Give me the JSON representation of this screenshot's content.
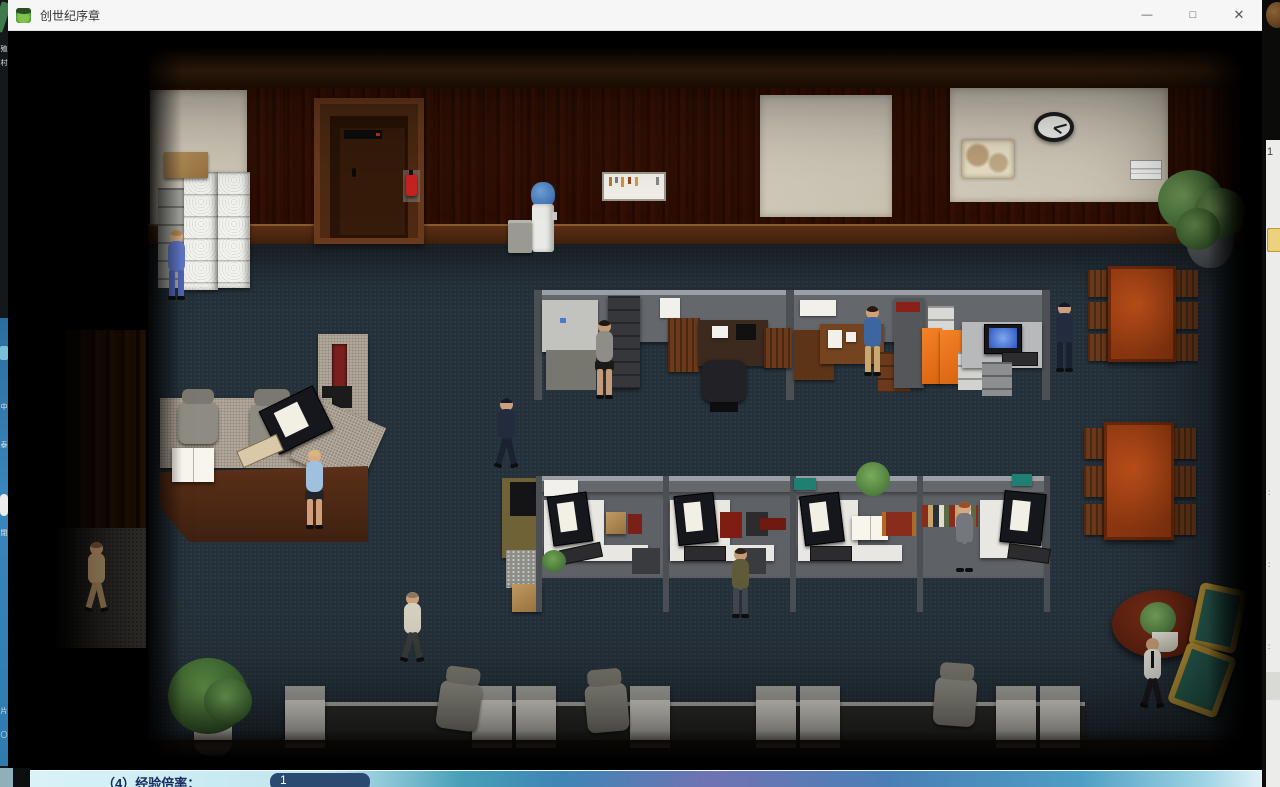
{
  "window": {
    "title": "创世纪序章",
    "controls": {
      "minimize": "—",
      "maximize": "□",
      "close": "✕"
    }
  },
  "background": {
    "left_edge": {
      "chars_top": [
        "殖",
        "村"
      ],
      "chars_blue": [
        "中",
        "泰",
        "閉",
        "片",
        "〇"
      ]
    },
    "right_edge": {
      "number": "1",
      "marks": [
        ":",
        ":",
        ":"
      ]
    },
    "bottom_bar": {
      "label": "（4）经验倍率：",
      "value": "1"
    }
  },
  "scene": {
    "people": [
      "woman-blue-suit",
      "walking-man-left",
      "reception-visitor-woman",
      "woman-gray-vest",
      "man-blue-sweater",
      "police-officer-standing",
      "police-officer-walking",
      "man-olive-sweater",
      "man-gray-suit",
      "bald-man-white-shirt"
    ],
    "objects": [
      "filing-cabinets",
      "cardboard-box",
      "reception-desk",
      "copier",
      "water-cooler",
      "trash-can",
      "notice-board",
      "wall-map",
      "wall-clock",
      "wall-plaque",
      "wooden-door",
      "fire-extinguisher",
      "conference-table",
      "cubicle-workstations",
      "orange-cabinets",
      "round-lounge-table",
      "teal-armchairs",
      "potted-plants",
      "queue-desks"
    ]
  },
  "colors": {
    "titlebar": "#f6f6f6",
    "carpet": "#25313a",
    "wood": "#754222",
    "door": "#371b0a",
    "beige_panel": "#d5cdbe",
    "partition": "#64676c",
    "orange_cabinet": "#e8721c",
    "conference_table": "#b04012",
    "teal_chair": "#2e6b5e",
    "gold_frame": "#c9a33c",
    "bottom_bar_left": "#cfeef4",
    "bottom_bar_value_bg": "#2b4a72"
  }
}
